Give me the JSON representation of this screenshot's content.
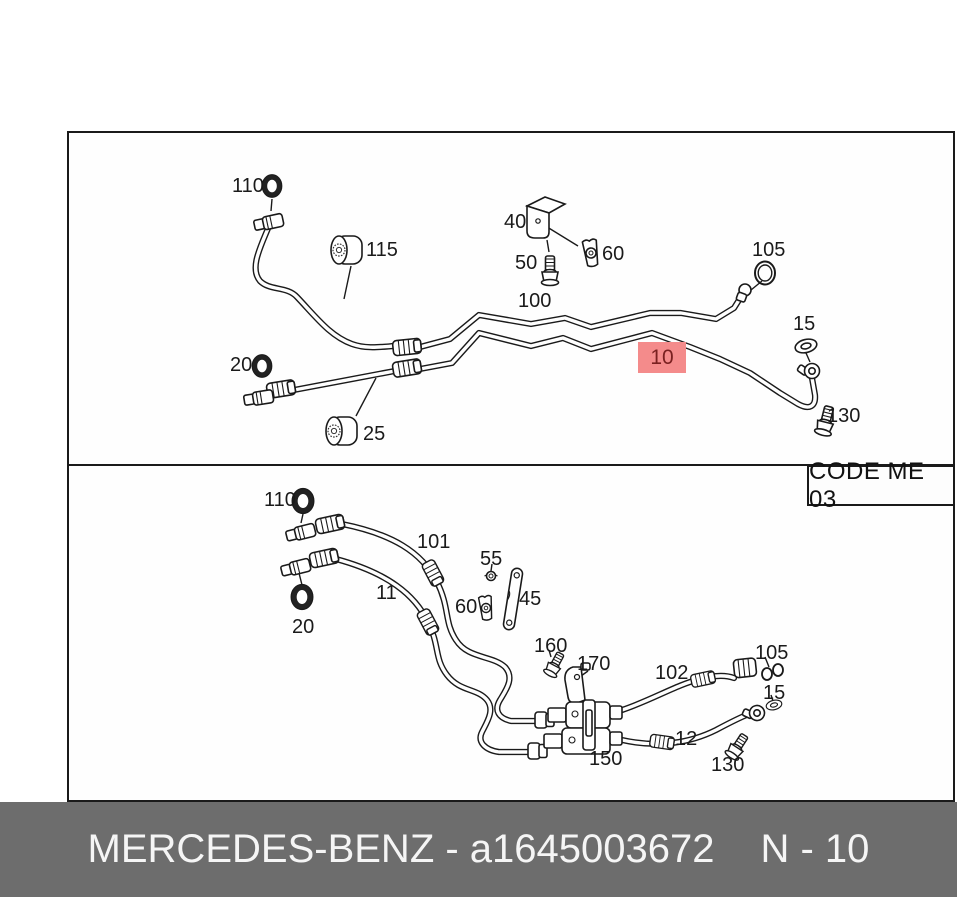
{
  "diagram": {
    "top_panel": {
      "labels": {
        "110": "110",
        "115": "115",
        "40": "40",
        "50": "50",
        "60": "60",
        "100": "100",
        "105": "105",
        "15": "15",
        "20": "20",
        "25": "25",
        "130": "130"
      },
      "highlighted_part": {
        "label": "10"
      }
    },
    "bottom_panel": {
      "labels": {
        "110": "110",
        "101": "101",
        "55": "55",
        "11": "11",
        "60": "60",
        "45": "45",
        "20": "20",
        "160": "160",
        "170": "170",
        "102": "102",
        "105": "105",
        "15": "15",
        "12": "12",
        "150": "150",
        "130": "130"
      }
    },
    "code_box": {
      "text": "CODE ME 03"
    }
  },
  "footer": {
    "brand_part": "MERCEDES-BENZ - a1645003672",
    "note": "N - 10"
  },
  "colors": {
    "highlight_bg": "#f48b8b",
    "highlight_text": "#7a2020",
    "footer_bg": "#6d6d6d",
    "footer_text": "#f5f5f5",
    "line": "#1a1a1a",
    "frame_border": "#1a1a1a"
  }
}
